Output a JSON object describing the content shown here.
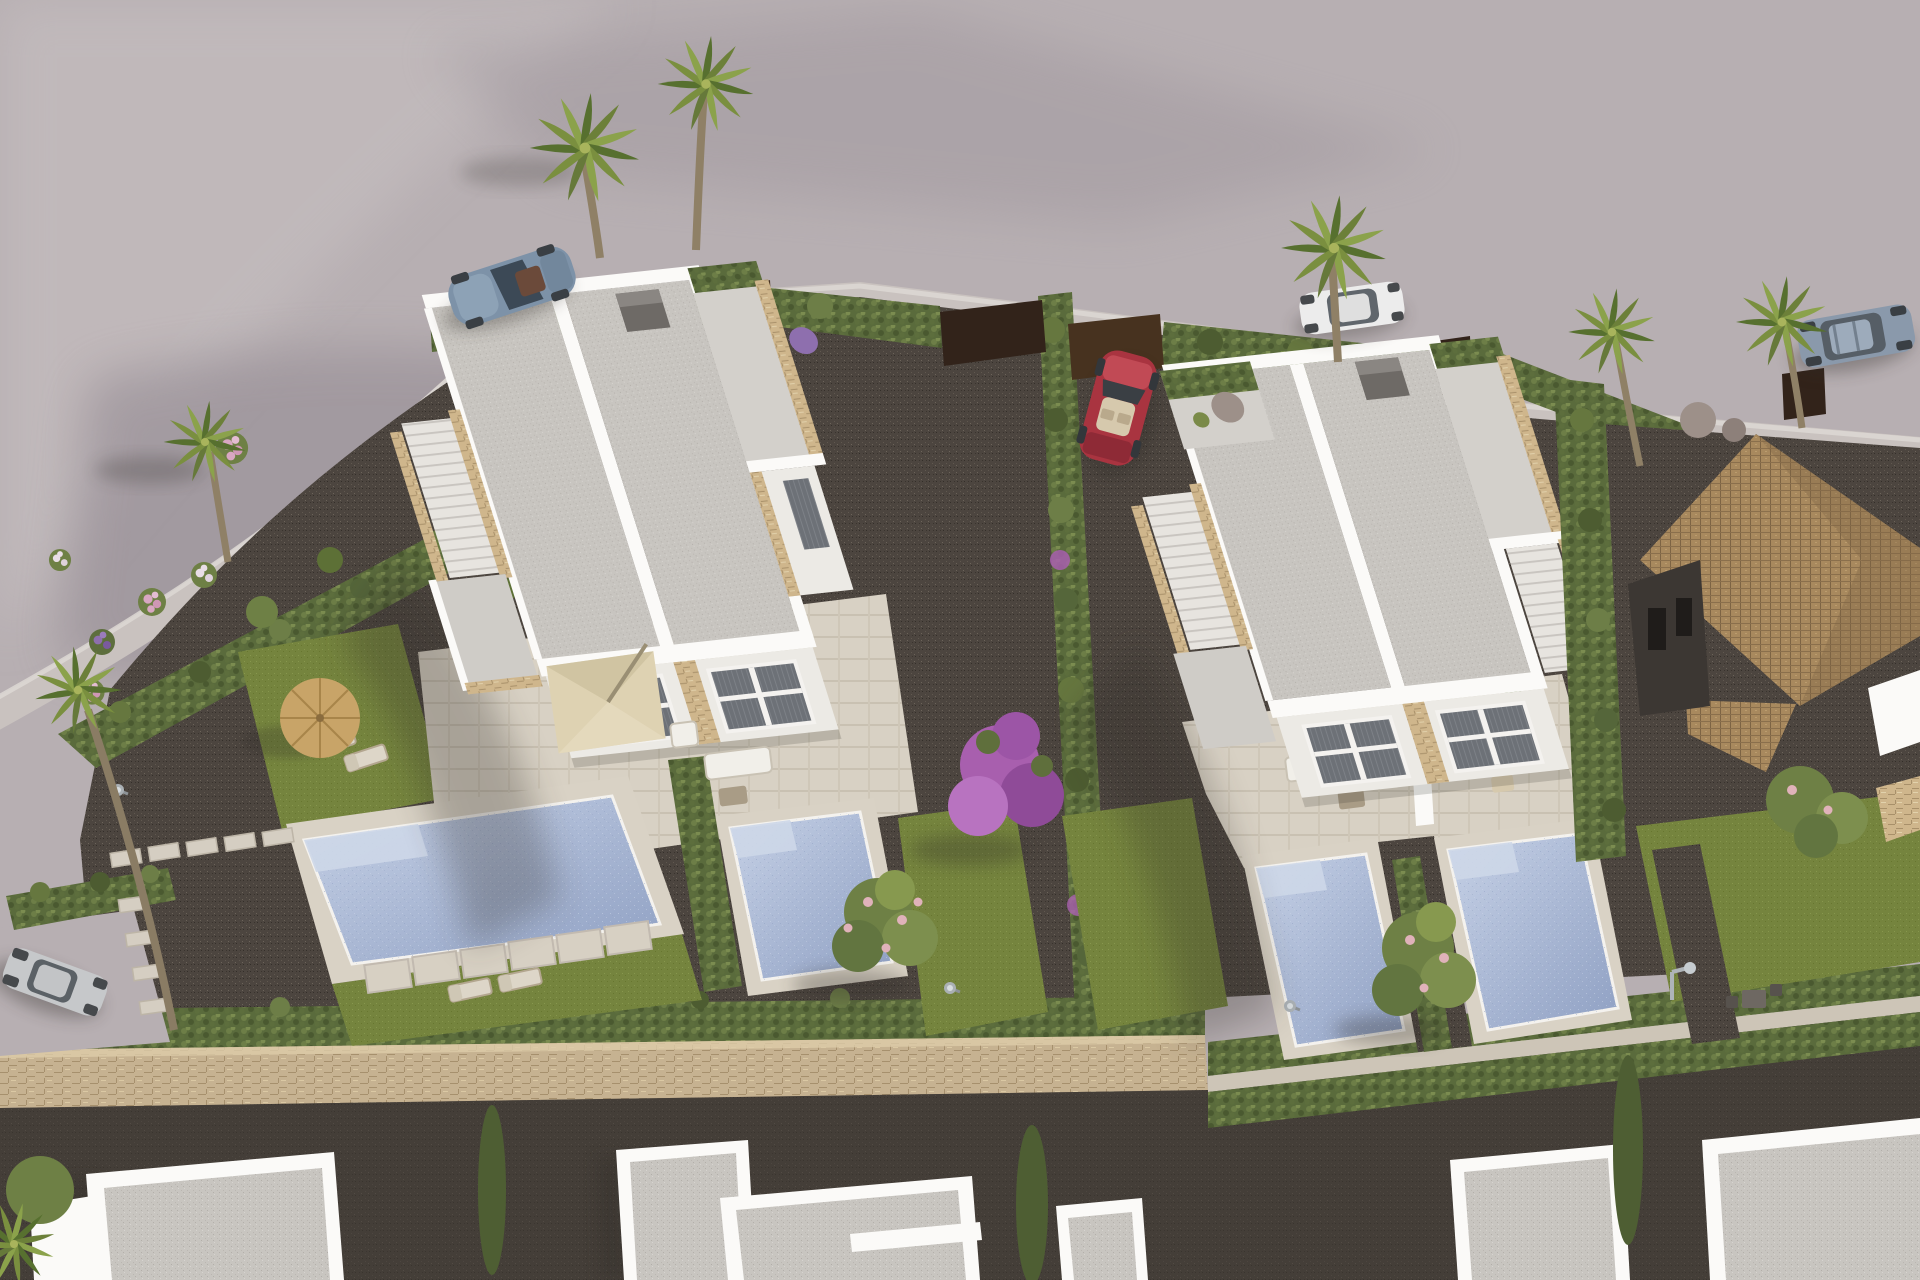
{
  "meta": {
    "title": "Aerial 3D rendering of a modern villa development",
    "description": "Bird's-eye architectural visualization: two white duplex villas with flat speckled roofs, rooftop terraces reached by stone-clad stairs, private pools and lawned gardens separated by cypress hedges. A red convertible is parked in the central driveway, a steel-blue sports car, a white sedan and a blue-grey SUV stand on the curved street above, and a silver hatchback waits in a lay-by at the lower left. A neighbouring house with a terracotta tiled roof sits at the right, palm trees and pink and purple flowering shrubs dot the gardens, and a row of unfinished white buildings lines the bottom behind a beige stone wall."
  },
  "palette": {
    "road": "#b7afb2",
    "roadlight": "#c8c1c2",
    "roadshadow": "#9b939a",
    "sidewalk": "#c9c2bf",
    "curb": "#ddd8d4",
    "gravel": "#4c453f",
    "gravellight": "#5a534c",
    "lane": "#3e3833",
    "lawn": "#75843e",
    "lawndark": "#5f6e33",
    "pool": "#a9b7d3",
    "pooldeep": "#8fa0c3",
    "poollight": "#c6d1e6",
    "poolsteps": "#cdd7e8",
    "pooldeck": "#d9d2c5",
    "wall": "#eceae5",
    "wallbright": "#fbfaf8",
    "wallshade": "#d8d5d0",
    "roof": "#c8c5c0",
    "rooflight": "#d3d0cb",
    "stone": "#cfb68c",
    "stonedark": "#a8906a",
    "stonewall": "#c6b291",
    "stonewalldark": "#a6906d",
    "tile": "#a8895e",
    "tiledark": "#7d6444",
    "facadedark": "#3c3733",
    "glass": "#6d7177",
    "glassdark": "#51555b",
    "frame": "#f4f2ef",
    "fence": "#47321f",
    "fencedark": "#32231a",
    "hedge": "#5a6b3c",
    "hedgedark": "#47562f",
    "cypress": "#4e5e33",
    "tree": "#6e8045",
    "blossom": "#e0b2ba",
    "bougainvillea": "#a85fae",
    "flpink": "#d9a7c2",
    "flwhite": "#e9dee6",
    "flpurple": "#8e6fae",
    "straw": "#c8a468",
    "strawdark": "#a8854a",
    "cream": "#ded2b2",
    "creamshade": "#c7ba98",
    "carblue": "#7d92a8",
    "carred": "#a93440",
    "carwhite": "#ececec",
    "carsilver": "#c6c8ca",
    "carsuv": "#8a99ab",
    "beige": "#d6c9ad",
    "trunk": "#8f8066",
    "shadow": "#2e2a27"
  },
  "scene": {
    "setting": "New-build residential development seen from above on a bright day, light warm-grey asphalt street curving around landscaped plots",
    "buildings": [
      {
        "id": "villa-left",
        "label": "White duplex villa, flat roof, rooftop terrace with stone-clad stair, two pools"
      },
      {
        "id": "villa-right",
        "label": "White duplex villa, flat roof, roof planter and terrace, two pools"
      },
      {
        "id": "mediterranean-house",
        "label": "Neighbouring house with terracotta tiled roof and dark facade"
      },
      {
        "id": "construction-row",
        "label": "Row of unfinished white flat-roofed buildings along the bottom lane"
      }
    ],
    "vehicles": [
      {
        "id": "sports-car",
        "color": "steel blue",
        "location": "street, top left"
      },
      {
        "id": "sedan",
        "color": "white",
        "location": "street, top centre, behind palm"
      },
      {
        "id": "convertible",
        "color": "red",
        "location": "gravel driveway between the villas"
      },
      {
        "id": "suv",
        "color": "blue-grey",
        "location": "street, top right"
      },
      {
        "id": "hatchback",
        "color": "silver",
        "location": "lay-by, bottom left"
      }
    ],
    "pools": [
      {
        "id": "pool-1",
        "villa": "left",
        "note": "large pool with corner steps"
      },
      {
        "id": "pool-2",
        "villa": "left",
        "note": "small pool"
      },
      {
        "id": "pool-3",
        "villa": "right"
      },
      {
        "id": "pool-4",
        "villa": "right"
      }
    ],
    "vegetation": {
      "palm_trees": 8,
      "cypress_hedges": "along every plot boundary and above the stone wall",
      "bougainvillea": "purple flowering tree between the two plots",
      "blossom_trees": 3,
      "flower_bushes": "pink, white and purple shrubs in the left garden"
    },
    "amenities": [
      "straw parasol with two sun loungers",
      "cream patio umbrella with dining set",
      "outdoor lounge sofas on both terraces",
      "stepping-stone paths",
      "garden lamps and outdoor shower",
      "beige stone boundary wall"
    ]
  }
}
